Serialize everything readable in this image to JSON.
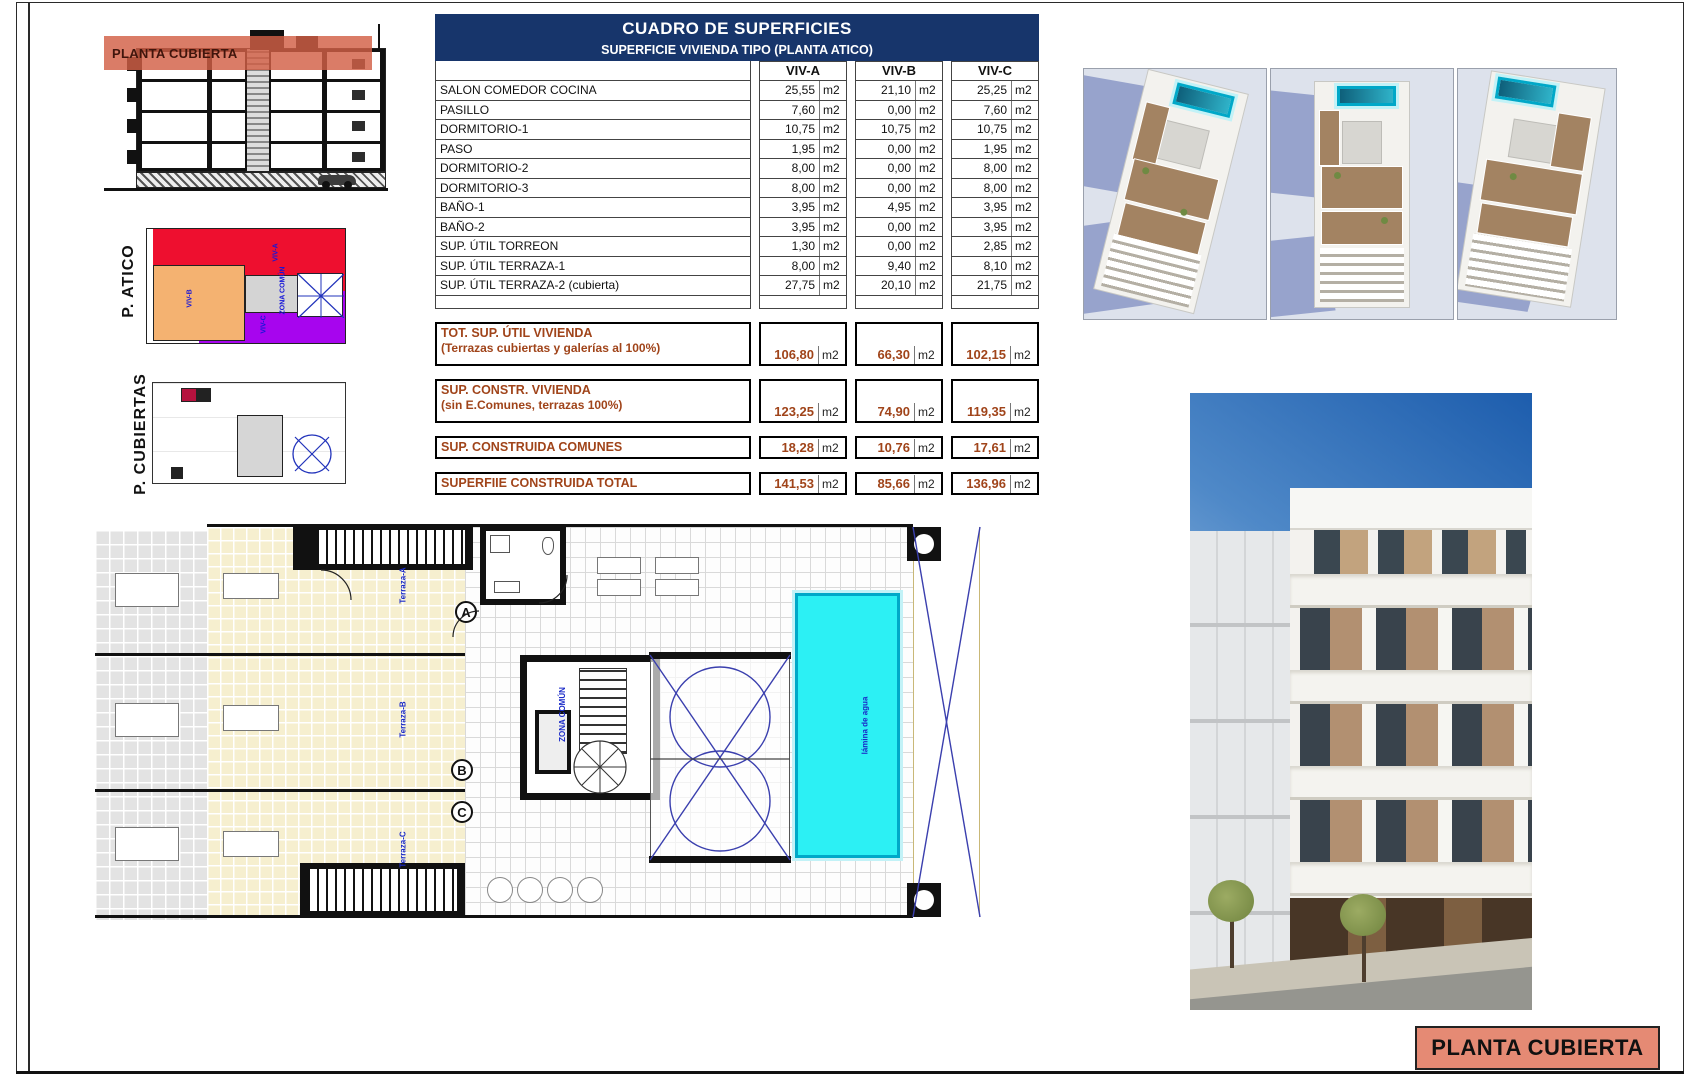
{
  "colors": {
    "header_navy": "#17356b",
    "summary_brown": "#a0441a",
    "salmon_band": "#d25f46",
    "title_salmon": "#e58a74",
    "pool_cyan": "#2cf0f4",
    "atico_red": "#ee0f2f",
    "atico_orange": "#f4b271",
    "atico_purple": "#a705ee",
    "annotation_blue": "#1a2ac8"
  },
  "table": {
    "title": "CUADRO DE SUPERFICIES",
    "subtitle": "SUPERFICIE VIVIENDA TIPO  (PLANTA ATICO)",
    "unit": "m2",
    "columns": [
      "VIV-A",
      "VIV-B",
      "VIV-C"
    ],
    "rows": [
      {
        "label": "SALON COMEDOR COCINA",
        "values": [
          "25,55",
          "21,10",
          "25,25"
        ]
      },
      {
        "label": "PASILLO",
        "values": [
          "7,60",
          "0,00",
          "7,60"
        ]
      },
      {
        "label": "DORMITORIO-1",
        "values": [
          "10,75",
          "10,75",
          "10,75"
        ]
      },
      {
        "label": "PASO",
        "values": [
          "1,95",
          "0,00",
          "1,95"
        ]
      },
      {
        "label": "DORMITORIO-2",
        "values": [
          "8,00",
          "0,00",
          "8,00"
        ]
      },
      {
        "label": "DORMITORIO-3",
        "values": [
          "8,00",
          "0,00",
          "8,00"
        ]
      },
      {
        "label": "BAÑO-1",
        "values": [
          "3,95",
          "4,95",
          "3,95"
        ]
      },
      {
        "label": "BAÑO-2",
        "values": [
          "3,95",
          "0,00",
          "3,95"
        ]
      },
      {
        "label": "SUP. ÚTIL TORREON",
        "values": [
          "1,30",
          "0,00",
          "2,85"
        ]
      },
      {
        "label": "SUP. ÚTIL TERRAZA-1",
        "values": [
          "8,00",
          "9,40",
          "8,10"
        ]
      },
      {
        "label": "SUP. ÚTIL TERRAZA-2 (cubierta)",
        "values": [
          "27,75",
          "20,10",
          "21,75"
        ]
      }
    ],
    "summary_rows": [
      {
        "label": "TOT. SUP. ÚTIL VIVIENDA",
        "sublabel": "(Terrazas cubiertas y galerías al 100%)",
        "values": [
          "106,80",
          "66,30",
          "102,15"
        ]
      },
      {
        "label": "SUP. CONSTR. VIVIENDA",
        "sublabel": "(sin E.Comunes, terrazas 100%)",
        "values": [
          "123,25",
          "74,90",
          "119,35"
        ]
      },
      {
        "label": "SUP. CONSTRUIDA COMUNES",
        "sublabel": "",
        "values": [
          "18,28",
          "10,76",
          "17,61"
        ]
      },
      {
        "label": "SUPERFIIE CONSTRUIDA TOTAL",
        "sublabel": "",
        "values": [
          "141,53",
          "85,66",
          "136,96"
        ]
      }
    ]
  },
  "section": {
    "band_label": "PLANTA CUBIERTA"
  },
  "side_plans": {
    "atico_label": "P. ATICO",
    "cubiertas_label": "P. CUBIERTAS",
    "atico_annotations": {
      "viv_a": "VIV-A",
      "viv_b": "VIV-B",
      "viv_c": "VIV-C",
      "zona": "ZONA COMÚN"
    }
  },
  "plan": {
    "letters": [
      "A",
      "B",
      "C"
    ],
    "annotations": {
      "terraza_a": "Terraza-A",
      "terraza_b": "Terraza-B",
      "terraza_c": "Terraza-C",
      "zona_comun": "ZONA COMÚN",
      "pool": "lámina de agua"
    }
  },
  "titlebox": {
    "label": "PLANTA CUBIERTA"
  }
}
